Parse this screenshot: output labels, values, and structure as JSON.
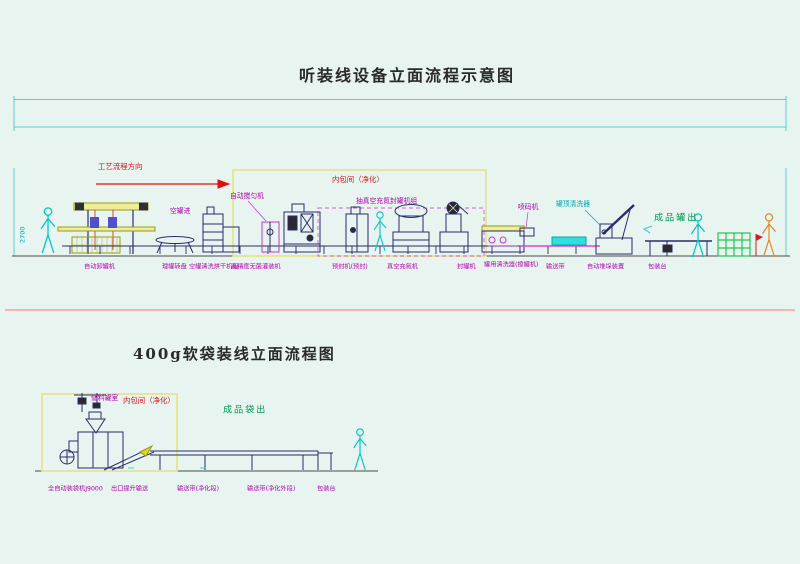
{
  "colors": {
    "background": "#e7f4f0",
    "cad_line_navy": "#2b2b6e",
    "cyan_accent": "#3fcfcf",
    "magenta_label": "#b400b4",
    "red_label": "#e01010",
    "green_label": "#009a55",
    "olive_frame": "#9a9a10",
    "pale_yellow_room": "#e3e388",
    "pink_divider": "#ff9b9b"
  },
  "top": {
    "title": "听装线设备立面流程示意图",
    "flow_dir": "工艺流程方向",
    "clean_room": "内包间（净化）",
    "dim": "2700",
    "callouts": {
      "mixer": "自动搅匀机",
      "empty_can_in": "空罐进",
      "vacuum_group": "抽真空充氮封罐机组",
      "coder": "喷码机",
      "can_top_washer": "罐顶清洗器",
      "product_out": "成品罐出"
    },
    "machines": [
      "自动卸罐机",
      "理罐转盘",
      "空罐清洗烘干机组",
      "高精度无菌灌装机",
      "预封机(预封)",
      "真空充氮机",
      "封罐机",
      "罐用清洗器(擦罐机)",
      "输送带",
      "自动堆垛装置",
      "包装台"
    ]
  },
  "bottom": {
    "title": "400g软袋装线立面流程图",
    "clean_room": "内包间（净化）",
    "hopper_room": "储料罐室",
    "product_out": "成品袋出",
    "machines": [
      "全自动装袋机J9000",
      "出口提升输送",
      "输送带(净化段)",
      "输送带(净化外段)",
      "包装台"
    ]
  }
}
